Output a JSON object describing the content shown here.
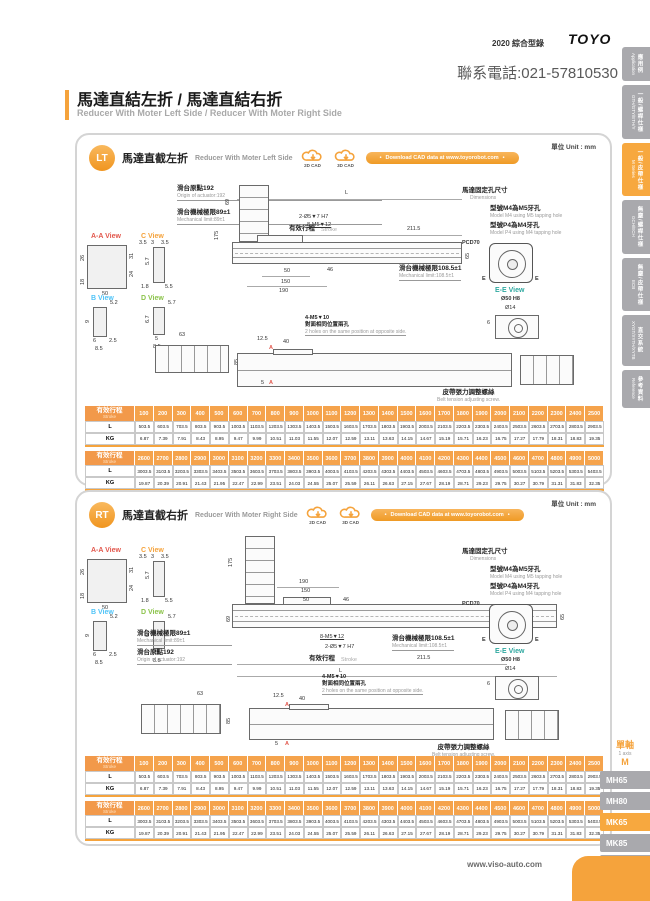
{
  "page": {
    "edition": "2020 綜合型錄",
    "brand": "TOYO",
    "phone": "聯系電話:021-57810530",
    "title_zh": "馬達直結左折 / 馬達直結右折",
    "title_en": "Reducer With Moter Left Side / Reducer With Moter Right Side",
    "unit_label": "單位 Unit : mm",
    "footer_url": "www.viso-auto.com",
    "accent_color": "#F5A33C"
  },
  "sidebar": {
    "tabs": [
      {
        "zh": "應用例",
        "en": "Application",
        "active": false
      },
      {
        "zh": "一般/螺桿仕樣",
        "en": "GTH/GTY/ETH/Y",
        "active": false
      },
      {
        "zh": "一般/皮帶仕樣",
        "en": "M Series",
        "active": true
      },
      {
        "zh": "無塵/螺桿仕樣",
        "en": "GCH/ECH",
        "active": false
      },
      {
        "zh": "無塵/皮帶仕樣",
        "en": "ECB",
        "active": false
      },
      {
        "zh": "直交系統",
        "en": "XYGT/XYTH/XYTB",
        "active": false
      },
      {
        "zh": "參考資料",
        "en": "Reference",
        "active": false
      }
    ]
  },
  "series_nav": {
    "group_zh": "單軸",
    "group_en": "1 axis",
    "series_code": "M",
    "models": [
      {
        "label": "MH65",
        "active": false
      },
      {
        "label": "MH80",
        "active": false
      },
      {
        "label": "MK65",
        "active": true
      },
      {
        "label": "MK85",
        "active": false
      },
      {
        "label": "MK110",
        "active": false
      }
    ]
  },
  "cad": {
    "cad2d": "2D CAD",
    "cad3d": "3D CAD",
    "pill": "Download CAD data at www.toyorobot.com"
  },
  "panels": [
    {
      "badge": "LT",
      "title_zh": "馬達直截左折",
      "title_en": "Reducer With Moter Left Side"
    },
    {
      "badge": "RT",
      "title_zh": "馬達直截右折",
      "title_en": "Reducer With Moter Right Side"
    }
  ],
  "drawing": {
    "origin_zh": "滑台原點192",
    "origin_en": "Origin of actuator:192",
    "mech89_zh": "滑台機械極限89±1",
    "mech89_en": "Mechanical limit:89±1",
    "mech108_zh": "滑台機械極限108.5±1",
    "mech108_en": "Mechanical limit:108.5±1",
    "stroke_zh": "有效行程",
    "stroke_en": "Stroke",
    "dim_L": "L",
    "dim_2115": "211.5",
    "dim_175": "175",
    "dim_69": "69",
    "dim_65": "65",
    "dim_46": "46",
    "dim_50": "50",
    "dim_150": "150",
    "dim_190": "190",
    "dim_125": "12.5",
    "dim_40": "40",
    "dim_5": "5",
    "dim_63": "63",
    "dim_85": "85",
    "dim_6": "6",
    "holes_top1": "2-Ø5▼7 H7",
    "holes_top2": "8-M5▼12",
    "holes_bot1": "4-M5▼10",
    "holes_bot2": "對面相同位置兩孔",
    "holes_bot3": "2 holes on the same position at opposite side.",
    "motor_holes_zh": "馬達固定孔尺寸",
    "motor_holes_en": "Dimensions",
    "m4_zh": "型號M4為M5牙孔",
    "m4_en": "Model M4 using M5 tapping hole",
    "p4_zh": "型號P4為M4牙孔",
    "p4_en": "Model P4 using M4 tapping hole",
    "pcd": "PCD70",
    "ee_label": "E-E View",
    "ee_d50": "Ø50 H8",
    "ee_d14": "Ø14",
    "belt_zh": "皮帶張力調整螺絲",
    "belt_en": "Belt tension adjusting screw.",
    "marker_a": "A",
    "marker_e": "E",
    "views": {
      "aa": {
        "label": "A-A View",
        "d26": "26",
        "d18": "18",
        "d50": "50",
        "d31": "31",
        "d24": "24"
      },
      "c": {
        "label": "C View",
        "d35a": "3.5",
        "d3": "3",
        "d35b": "3.5",
        "d57": "5.7",
        "d18": "1.8",
        "d55": "5.5"
      },
      "b": {
        "label": "B View",
        "d52": "5.2",
        "d9": "9",
        "d6": "6",
        "d25": "2.5",
        "d85": "8.5"
      },
      "d": {
        "label": "D View",
        "d57": "5.7",
        "d67": "6.7",
        "d5": "5",
        "d85": "8.5"
      }
    }
  },
  "tables": [
    {
      "stroke_zh": "有效行程",
      "stroke_en": "Stroke",
      "row_l": "L",
      "row_kg": "KG",
      "strokes": [
        "100",
        "200",
        "300",
        "400",
        "500",
        "600",
        "700",
        "800",
        "900",
        "1000",
        "1100",
        "1200",
        "1300",
        "1400",
        "1500",
        "1600",
        "1700",
        "1800",
        "1900",
        "2000",
        "2100",
        "2200",
        "2300",
        "2400",
        "2500"
      ],
      "l": [
        "503.5",
        "603.5",
        "703.5",
        "803.5",
        "903.5",
        "1003.5",
        "1103.5",
        "1203.5",
        "1303.5",
        "1403.5",
        "1503.5",
        "1603.5",
        "1703.5",
        "1803.5",
        "1903.5",
        "2003.5",
        "2103.5",
        "2203.5",
        "2303.5",
        "2403.5",
        "2503.5",
        "2603.5",
        "2703.5",
        "2803.5",
        "2903.5"
      ],
      "kg": [
        "6.87",
        "7.39",
        "7.91",
        "8.43",
        "8.95",
        "9.47",
        "9.99",
        "10.51",
        "11.03",
        "11.55",
        "12.07",
        "12.59",
        "13.11",
        "13.63",
        "14.15",
        "14.67",
        "15.19",
        "15.71",
        "16.23",
        "16.75",
        "17.27",
        "17.79",
        "18.31",
        "18.83",
        "19.35"
      ]
    },
    {
      "stroke_zh": "有效行程",
      "stroke_en": "Stroke",
      "row_l": "L",
      "row_kg": "KG",
      "strokes": [
        "2600",
        "2700",
        "2800",
        "2900",
        "3000",
        "3100",
        "3200",
        "3300",
        "3400",
        "3500",
        "3600",
        "3700",
        "3800",
        "3900",
        "4000",
        "4100",
        "4200",
        "4300",
        "4400",
        "4500",
        "4600",
        "4700",
        "4800",
        "4900",
        "5000"
      ],
      "l": [
        "3003.5",
        "3103.5",
        "3203.5",
        "3303.5",
        "3403.5",
        "3503.5",
        "3603.5",
        "3703.5",
        "3803.5",
        "3903.5",
        "4003.5",
        "4103.5",
        "4203.5",
        "4303.5",
        "4403.5",
        "4503.5",
        "4603.5",
        "4703.5",
        "4803.5",
        "4903.5",
        "5003.5",
        "5103.5",
        "5203.5",
        "5303.5",
        "5403.5"
      ],
      "kg": [
        "19.87",
        "20.39",
        "20.91",
        "21.43",
        "21.95",
        "22.47",
        "22.99",
        "23.51",
        "24.03",
        "24.55",
        "25.07",
        "25.59",
        "26.11",
        "26.63",
        "27.15",
        "27.67",
        "28.19",
        "28.71",
        "29.23",
        "29.75",
        "30.27",
        "30.79",
        "31.31",
        "31.83",
        "32.35"
      ]
    }
  ]
}
